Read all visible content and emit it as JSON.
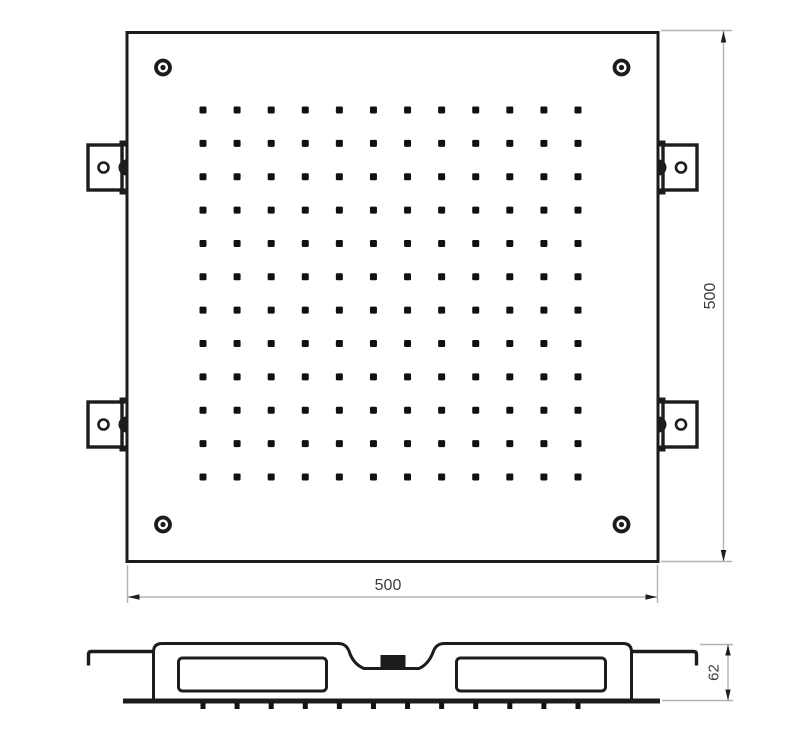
{
  "drawing": {
    "background": "#ffffff",
    "line_color": "#1c1c1c",
    "dim_line_color": "#b2b2b2",
    "dim_text_color": "#3c3c3c",
    "top_view": {
      "width_dim_label": "500",
      "height_dim_label": "500",
      "corner_screw_count": 4,
      "mounting_bracket_count": 4,
      "nozzle_grid": {
        "cols": 12,
        "rows": 12,
        "x0": 203,
        "y0": 110,
        "dx": 34.09,
        "dy": 33.36,
        "dot_size": 7,
        "corner_radius": 1.2
      }
    },
    "section_view": {
      "depth_dim_label": "62",
      "nozzle_ticks": {
        "count": 12,
        "x0": 203,
        "dx": 34.09,
        "y": 702.5,
        "w": 5,
        "h": 6.5
      }
    }
  }
}
